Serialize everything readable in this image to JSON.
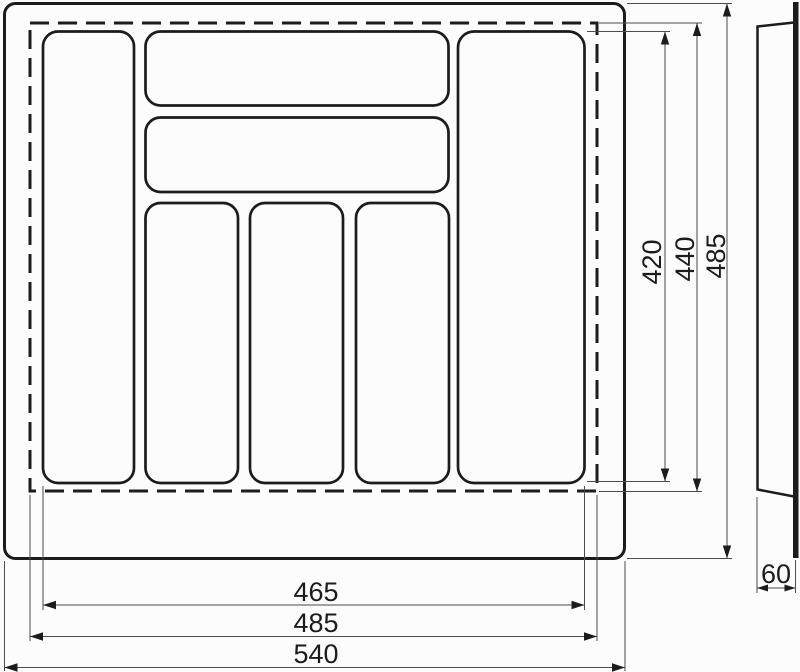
{
  "drawing": {
    "dimensions": {
      "compartments_width": "465",
      "trim_width": "485",
      "overall_width": "540",
      "compartments_height": "420",
      "trim_height": "440",
      "overall_height": "485",
      "side_height": "60"
    },
    "colors": {
      "line": "#1c1c1c",
      "dim_line": "#4d4d4d",
      "background": "#fcfcfc"
    }
  }
}
